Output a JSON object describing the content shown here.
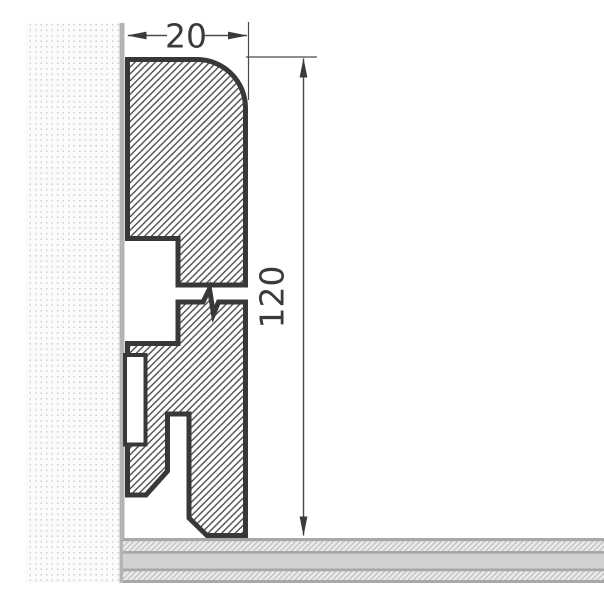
{
  "drawing": {
    "type": "skirting-board-profile-cross-section",
    "description": "Technical cross-section drawing of a skirting board mounted against a wall on a floor, with a break symbol in the profile height",
    "dimension_width_label": "20",
    "dimension_height_label": "120",
    "colors": {
      "profile_outline": "#383838",
      "profile_hatch": "#454545",
      "dimension": "#3a3a3a",
      "wall_edge": "#b4b4b4",
      "wall_dot": "#cdcdcd",
      "floor_band": "#d2d2d2",
      "floor_line": "#a8a8a8",
      "floor_hatch_bg": "#ececec",
      "floor_hatch": "#c2c2c2"
    }
  }
}
